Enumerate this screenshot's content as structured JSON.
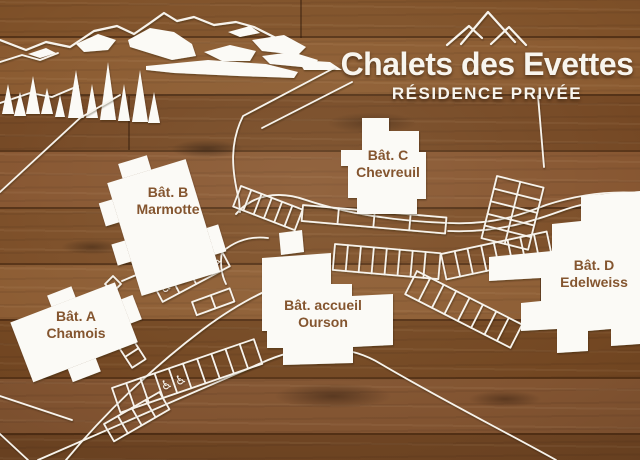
{
  "sign": {
    "title": "Chalets des Evettes",
    "subtitle": "RÉSIDENCE PRIVÉE"
  },
  "logo": {
    "name": "three-peaks-mountain-logo"
  },
  "buildings": [
    {
      "name": "Bât. C",
      "subname": "Chevreuil"
    },
    {
      "name": "Bât. B",
      "subname": "Marmotte"
    },
    {
      "name": "Bât. A",
      "subname": "Chamois"
    },
    {
      "name": "Bât. accueil",
      "subname": "Ourson"
    },
    {
      "name": "Bât. D",
      "subname": "Edelweiss"
    }
  ],
  "icons": {
    "accessible_parking_glyph": "♿"
  },
  "colors": {
    "wood_base": "#7d4f28",
    "wood_dark": "#5d3a1c",
    "wood_light": "#8d5d33",
    "line_white": "#f7f3ec",
    "label_brown": "#84552f"
  }
}
